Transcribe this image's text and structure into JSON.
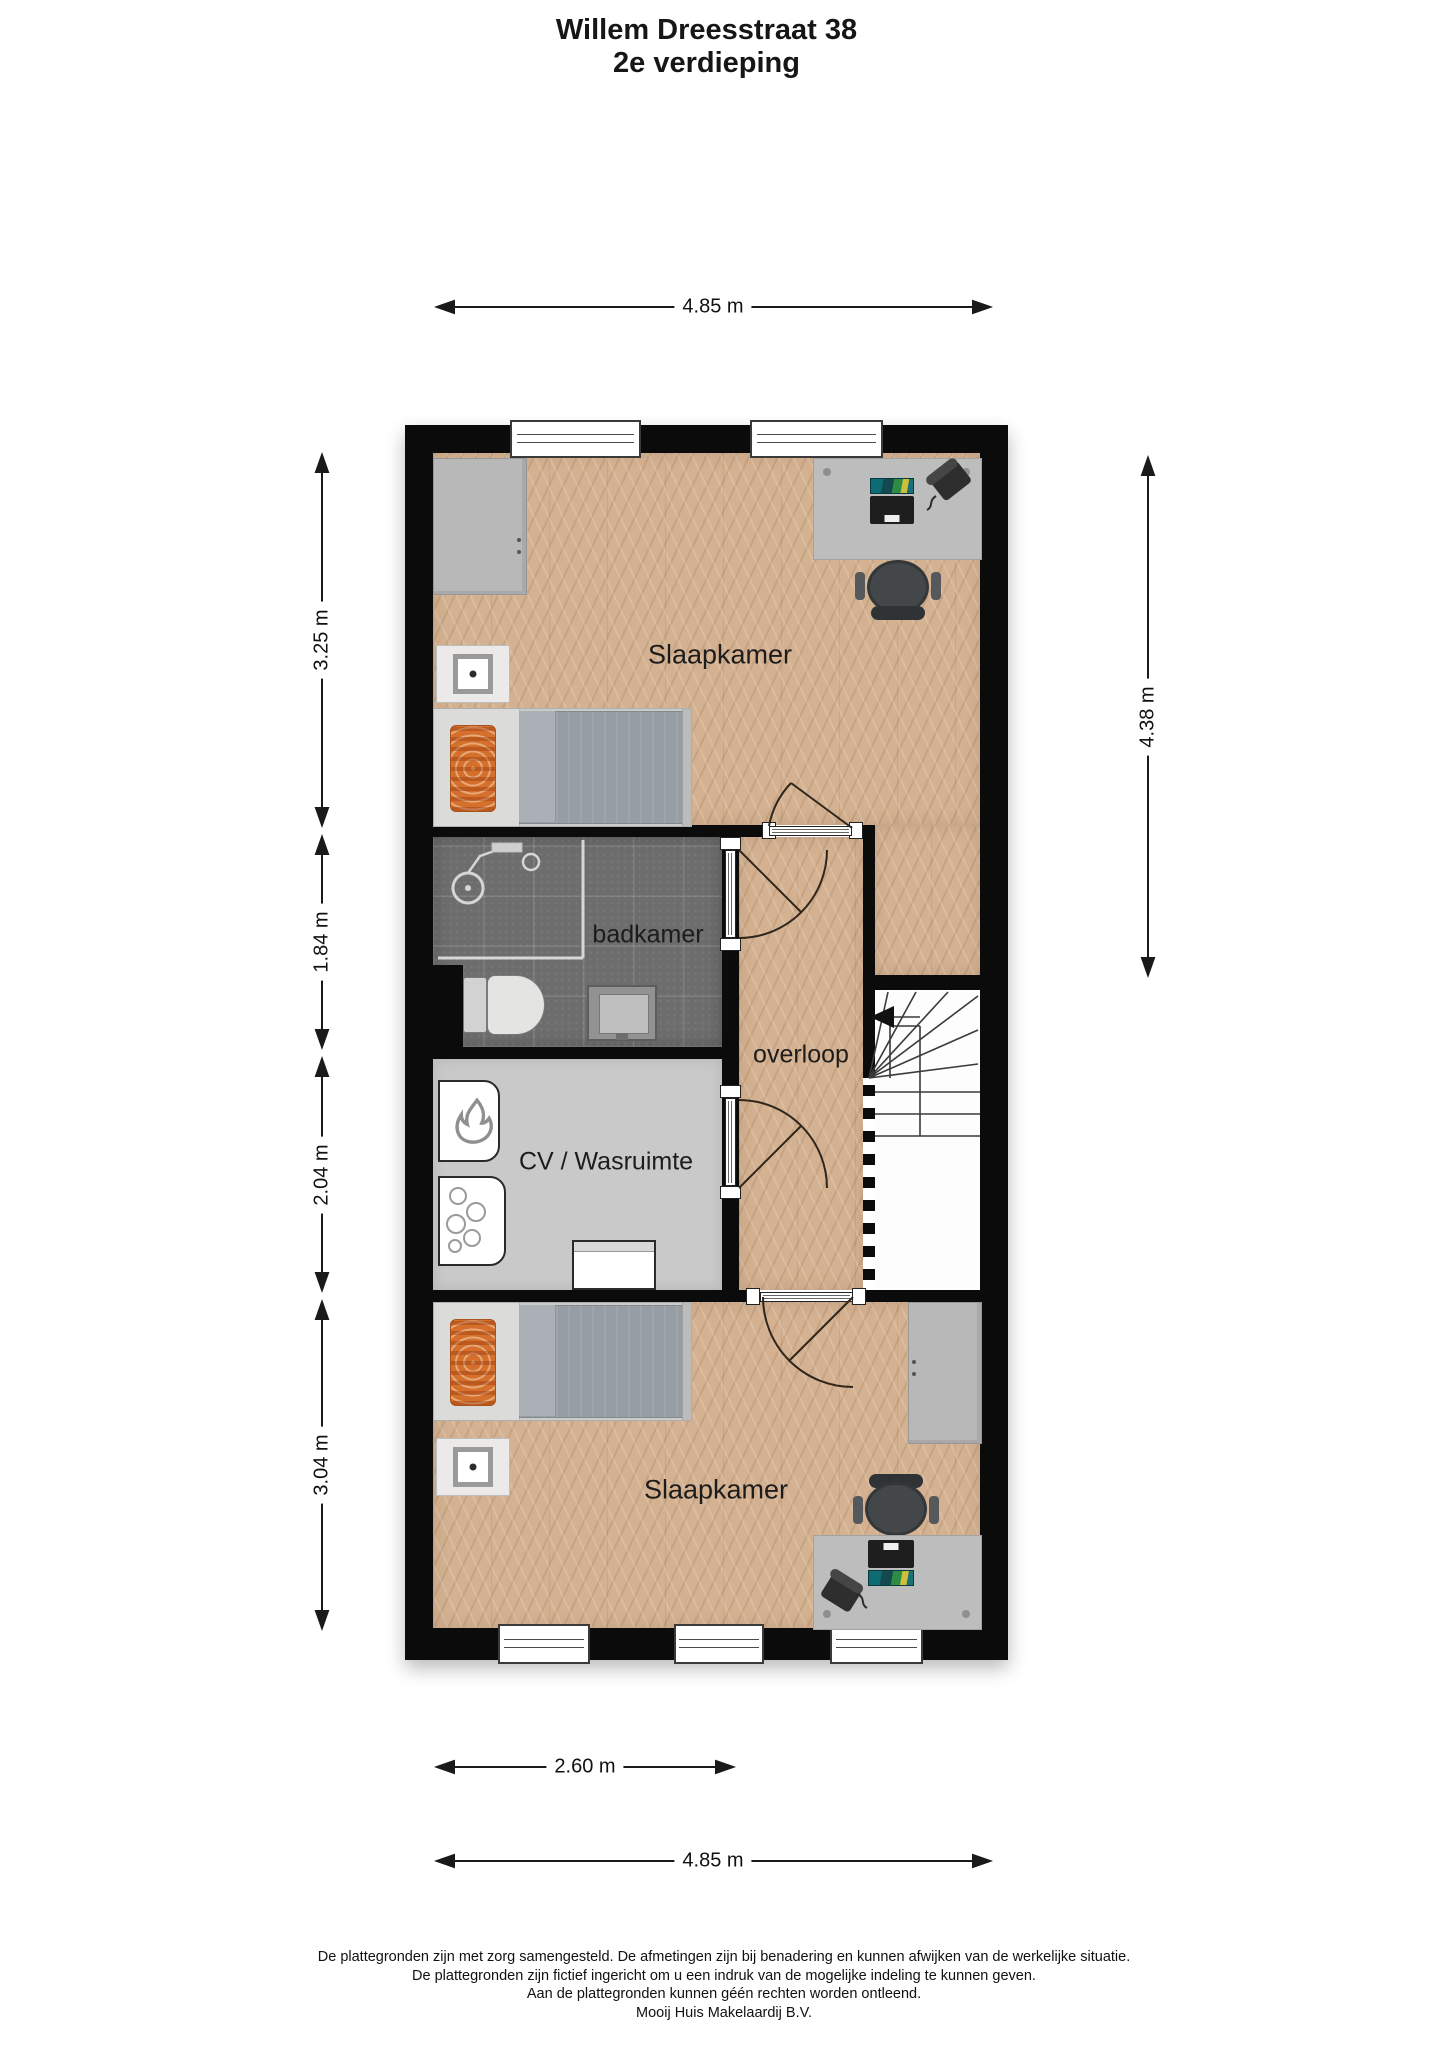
{
  "title": {
    "line1": "Willem Dreesstraat 38",
    "line2": "2e verdieping"
  },
  "rooms": {
    "bedroom_top": {
      "label": "Slaapkamer"
    },
    "bathroom": {
      "label": "badkamer"
    },
    "landing": {
      "label": "overloop"
    },
    "utility": {
      "label": "CV / Wasruimte"
    },
    "bedroom_bottom": {
      "label": "Slaapkamer"
    }
  },
  "dimensions": {
    "top_width": "4.85 m",
    "left_top": "3.25 m",
    "left_upper_mid": "1.84 m",
    "left_lower_mid": "2.04 m",
    "left_bottom": "3.04 m",
    "right_height": "4.38 m",
    "bottom_inner": "2.60 m",
    "bottom_width": "4.85 m"
  },
  "footer": {
    "line1": "De plattegronden zijn met zorg samengesteld. De afmetingen zijn bij benadering en kunnen afwijken van de werkelijke situatie.",
    "line2": "De plattegronden zijn fictief ingericht om u een indruk van de mogelijke indeling te kunnen geven.",
    "line3": "Aan de plattegronden kunnen géén rechten worden ontleend.",
    "line4": "Mooij Huis Makelaardij B.V."
  },
  "icons": {
    "stairs_direction": "left-arrow",
    "boiler": "flame",
    "nightstand_lamp": "dot"
  },
  "colors": {
    "wall": "#0b0b0b",
    "wood_floor": "#d4b190",
    "bathroom_tile": "#6d6d6d",
    "utility_floor": "#c9c9c9",
    "pillow_orange": "#d4702c",
    "laptop_screen_teal": "#0e6b74",
    "dimension_line": "#1a1a1a"
  }
}
